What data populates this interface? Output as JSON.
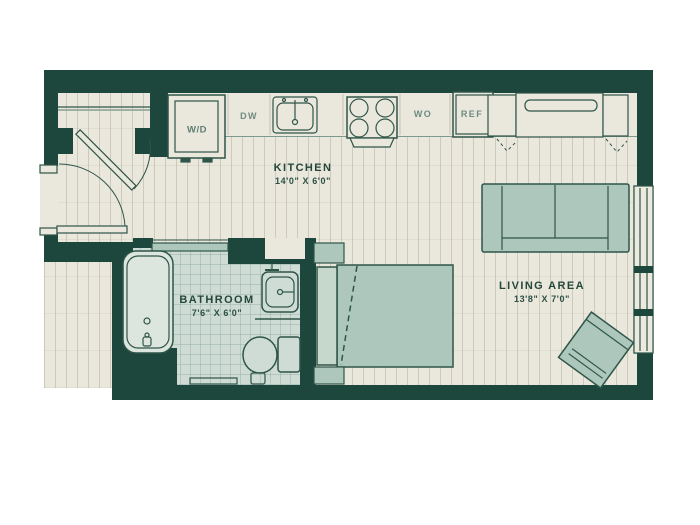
{
  "floor_plan": {
    "rooms": {
      "kitchen": {
        "name": "KITCHEN",
        "dims": "14'0\" X 6'0\""
      },
      "bathroom": {
        "name": "BATHROOM",
        "dims": "7'6\" X 6'0\""
      },
      "living": {
        "name": "LIVING AREA",
        "dims": "13'8\" X 7'0\""
      }
    },
    "appliances": {
      "washer_dryer": "W/D",
      "dishwasher": "DW",
      "wall_oven": "WO",
      "refrigerator": "REF"
    },
    "fixtures": [
      "entry-door",
      "entry-closet",
      "bathtub",
      "bathroom-sink",
      "toilet",
      "sliding-bathroom-door",
      "kitchen-sink",
      "stove",
      "refrigerator",
      "bed",
      "nightstands",
      "sofa",
      "accent-chair",
      "wardrobe-closet",
      "window"
    ],
    "colors": {
      "wall": "#1d473d",
      "floor": "#eae7dc",
      "tile": "#cedcd5",
      "furniture": "#adc7bc",
      "furniture_border": "#2f5549",
      "text": "#24473c",
      "appliance_text": "#6e8b80"
    }
  }
}
